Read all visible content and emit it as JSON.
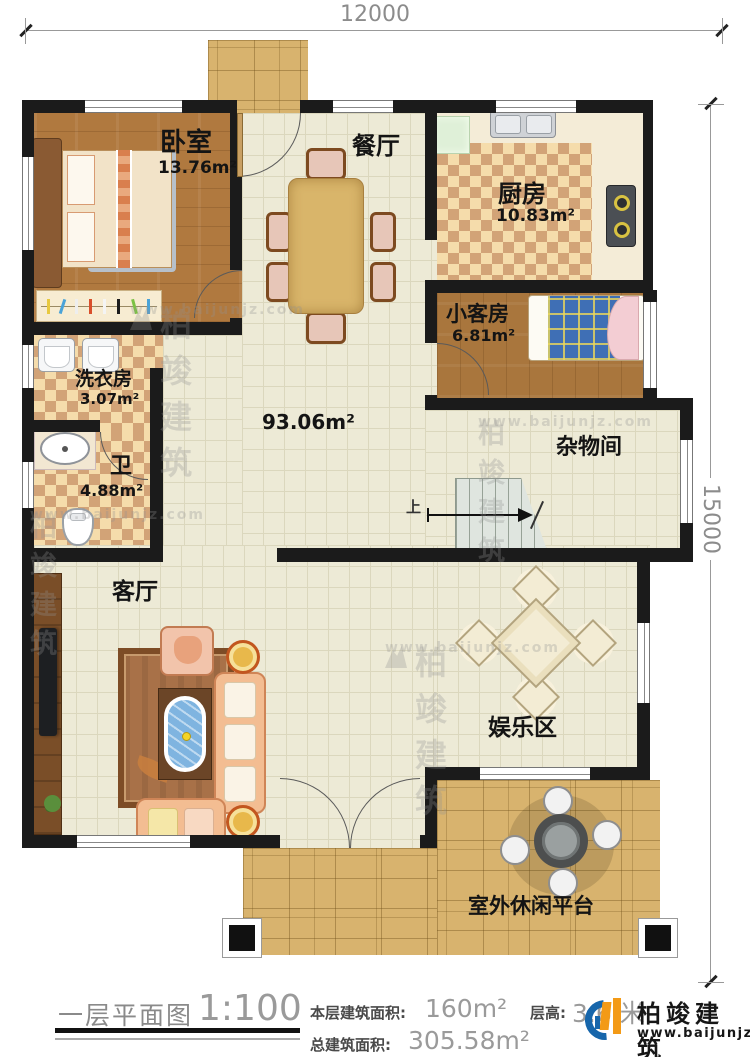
{
  "dimensions": {
    "width_label": "12000",
    "height_label": "15000"
  },
  "rooms": {
    "bedroom": {
      "name": "卧室",
      "area": "13.76m²"
    },
    "dining": {
      "name": "餐厅"
    },
    "kitchen": {
      "name": "厨房",
      "area": "10.83m²"
    },
    "guest_room": {
      "name": "小客房",
      "area": "6.81m²"
    },
    "laundry": {
      "name": "洗衣房",
      "area": "3.07m²"
    },
    "bathroom": {
      "name": "卫",
      "area": "4.88m²"
    },
    "hall": {
      "area": "93.06m²"
    },
    "storage": {
      "name": "杂物间"
    },
    "living": {
      "name": "客厅"
    },
    "entertainment": {
      "name": "娱乐区"
    },
    "terrace": {
      "name": "室外休闲平台"
    }
  },
  "stairs": {
    "direction_label": "上"
  },
  "footer": {
    "plan_title": "一层平面图",
    "scale": "1:100",
    "floor_area_label": "本层建筑面积:",
    "floor_area_value": "160m²",
    "storey_height_label": "层高:",
    "storey_height_value": "3.6 米",
    "total_area_label": "总建筑面积:",
    "total_area_value": "305.58m²"
  },
  "brand": {
    "name": "柏竣建筑",
    "website": "www.baijunjz.com"
  },
  "watermark": {
    "name": "柏竣建筑",
    "website": "www.baijunjz.com"
  },
  "colors": {
    "wall": "#1b1b1b",
    "accent_blue": "#1766ab",
    "accent_orange": "#f39a16"
  }
}
